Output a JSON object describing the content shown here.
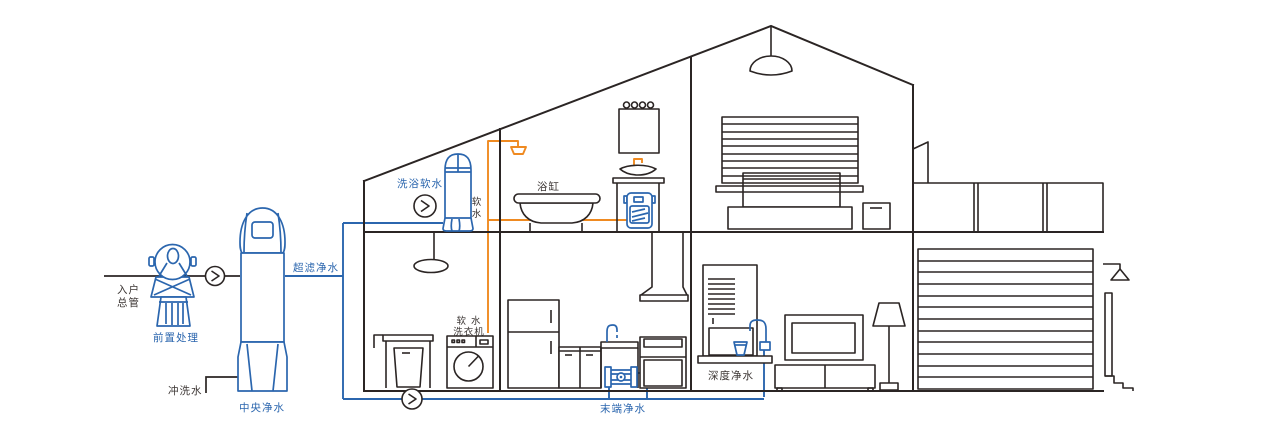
{
  "diagram_type": "whole-house water purification system schematic (house cross-section)",
  "colors": {
    "structure_line": "#2b2524",
    "water_device_blue": "#2b66ae",
    "soft_water_pipe_orange": "#ef8a21",
    "purified_water_pipe_blue": "#2b66ae",
    "dark_label": "#3b3533"
  },
  "icons": {
    "flow_direction_icon": "❯"
  },
  "labels": {
    "main_inlet_line1": "入户",
    "main_inlet_line2": "总管",
    "pre_treatment": "前置处理",
    "flush_water": "冲洗水",
    "central_purification": "中央净水",
    "ultrafiltration": "超滤净水",
    "bath_softening": "洗浴软水",
    "soft_water_char1": "软",
    "soft_water_char2": "水",
    "bathtub": "浴缸",
    "washer_line1": "软 水",
    "washer_line2": "洗衣机",
    "terminal_purification": "末端净水",
    "deep_purification": "深度净水"
  }
}
